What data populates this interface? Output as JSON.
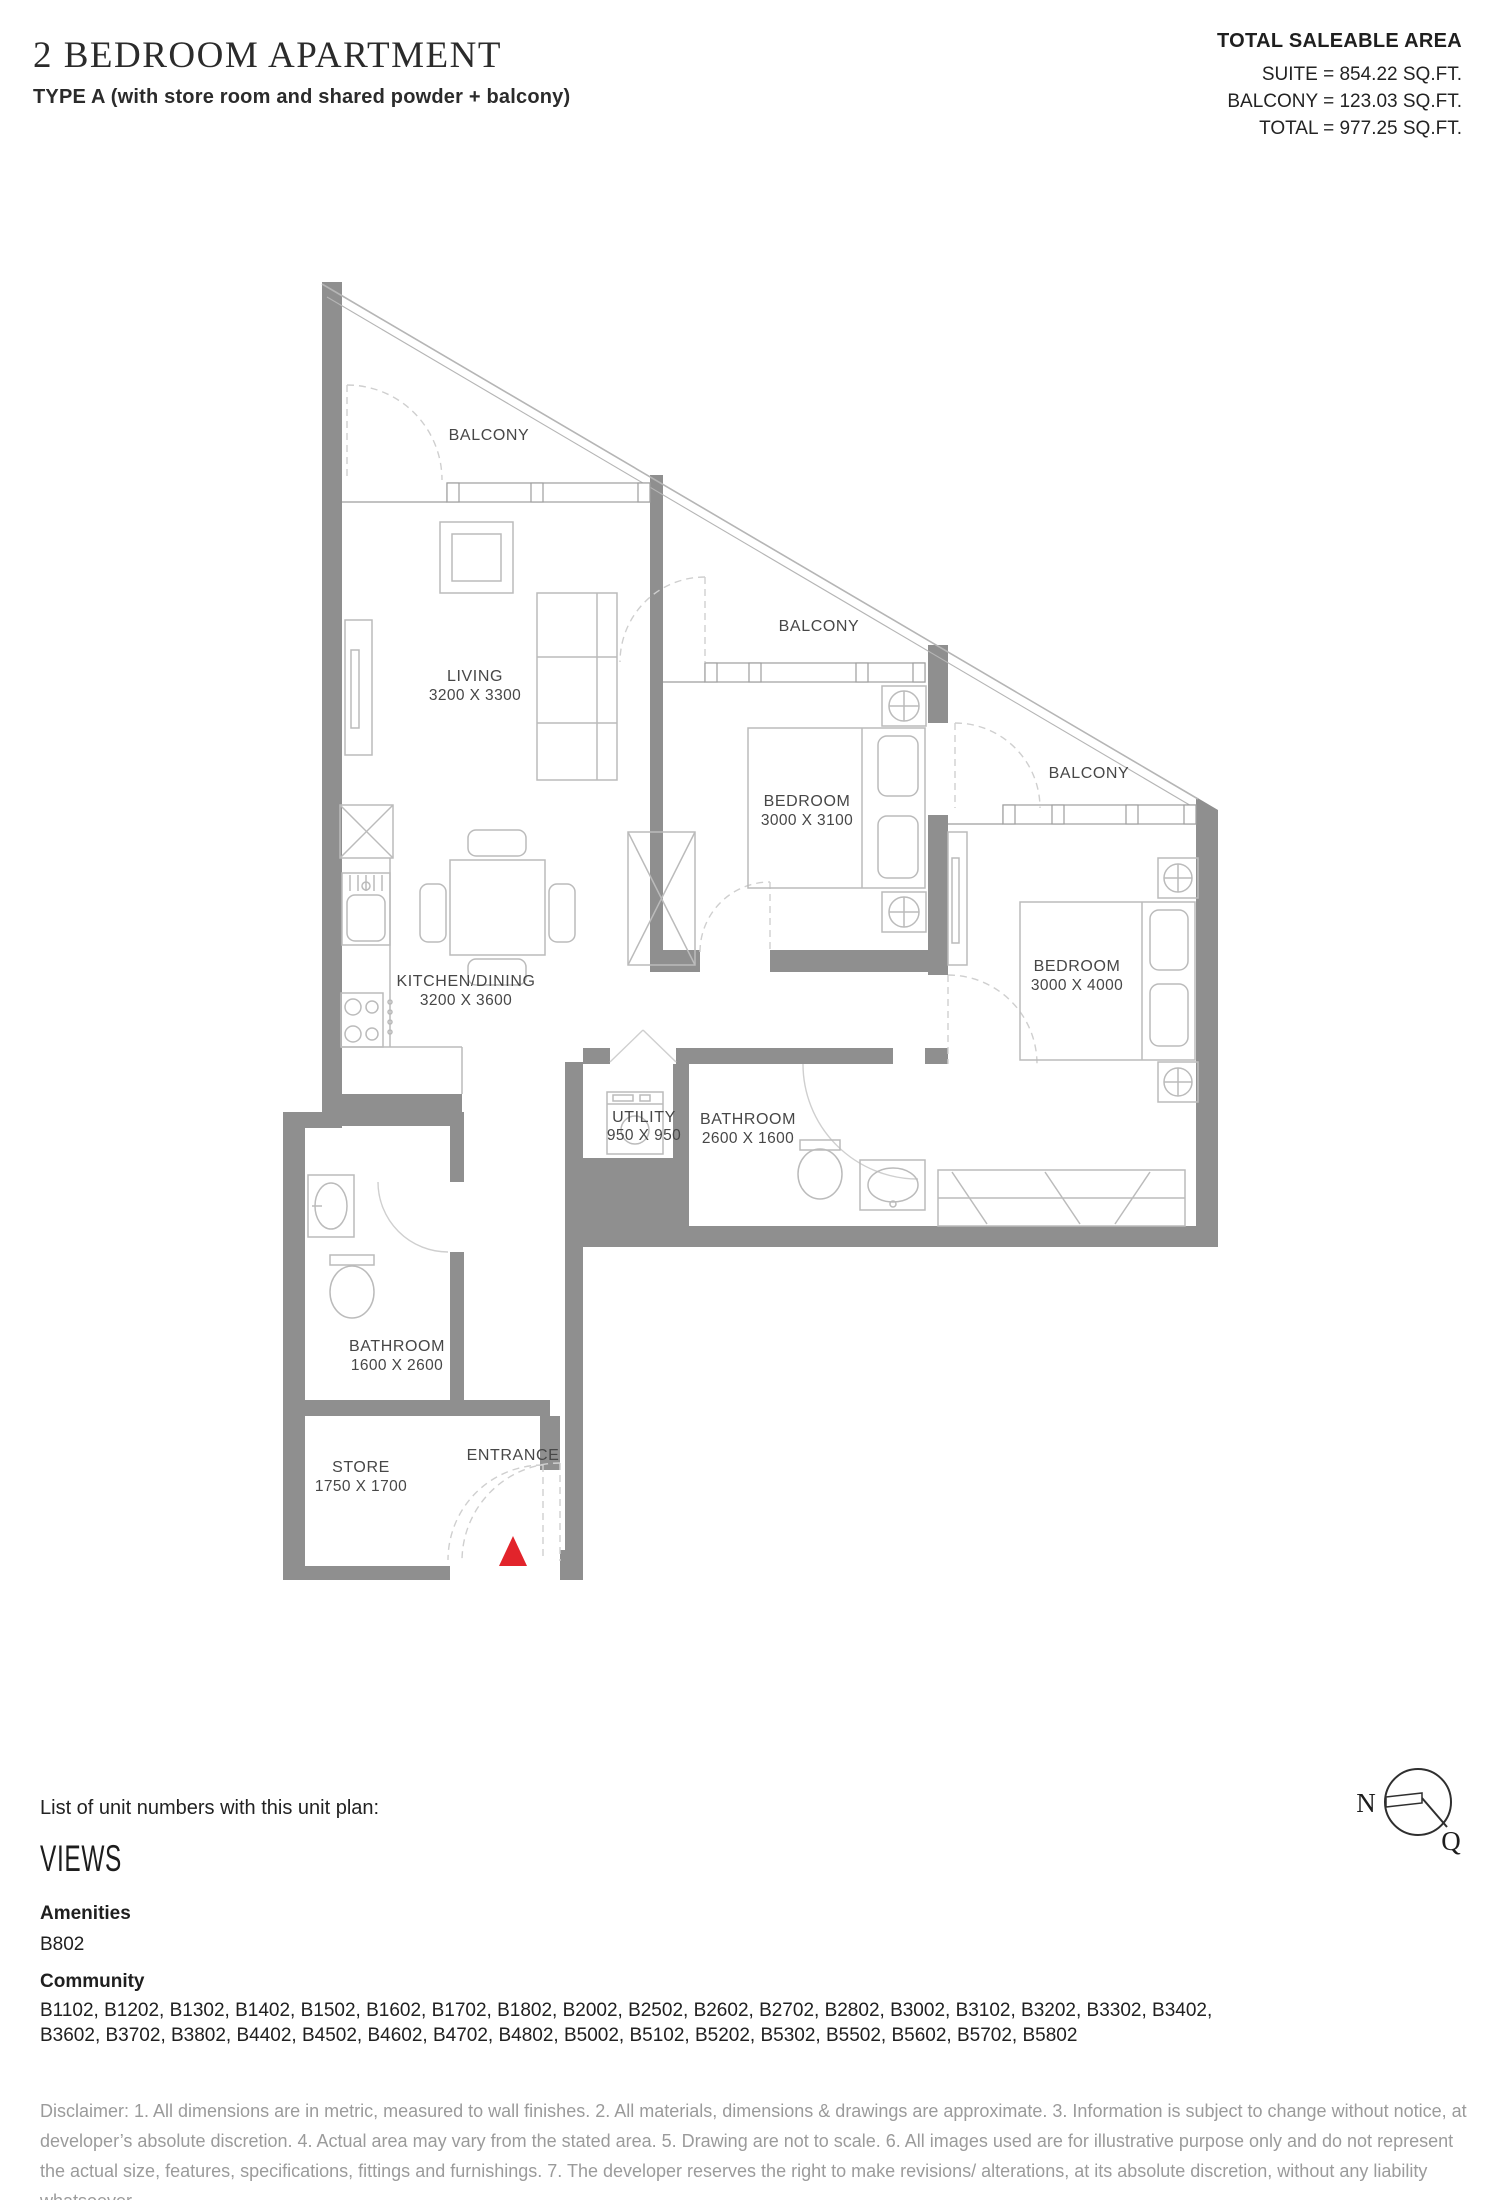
{
  "header": {
    "title": "2 BEDROOM APARTMENT",
    "subtitle": "TYPE A (with store room and shared powder + balcony)",
    "area_summary": {
      "heading": "TOTAL SALEABLE AREA",
      "suite": "SUITE = 854.22 SQ.FT.",
      "balcony": "BALCONY = 123.03 SQ.FT.",
      "total": "TOTAL = 977.25 SQ.FT."
    }
  },
  "floor_plan": {
    "rooms": [
      {
        "name": "LIVING",
        "dims": "3200 X 3300"
      },
      {
        "name": "BEDROOM",
        "dims": "3000 X 3100"
      },
      {
        "name": "BEDROOM",
        "dims": "3000 X 4000"
      },
      {
        "name": "KITCHEN/DINING",
        "dims": "3200 X 3600"
      },
      {
        "name": "UTILITY",
        "dims": "950 X 950"
      },
      {
        "name": "BATHROOM",
        "dims": "2600 X 1600"
      },
      {
        "name": "BATHROOM",
        "dims": "1600 X 2600"
      },
      {
        "name": "STORE",
        "dims": "1750 X 1700"
      }
    ],
    "balconies": [
      "BALCONY",
      "BALCONY",
      "BALCONY"
    ],
    "entrance_label": "ENTRANCE",
    "compass": {
      "north": "N",
      "qibla": "Q"
    },
    "colors": {
      "wall": "#8f8f8f",
      "entrance_marker": "#e2242b",
      "furniture_line": "#bbbbbb"
    }
  },
  "footer": {
    "list_title": "List of unit numbers with this unit plan:",
    "views_heading": "VIEWS",
    "amenities_label": "Amenities",
    "amenities_units": "B802",
    "community_label": "Community",
    "community_units_lines": [
      "B1102, B1202, B1302, B1402, B1502, B1602, B1702, B1802, B2002, B2502, B2602, B2702, B2802, B3002, B3102, B3202, B3302, B3402,",
      "B3602, B3702, B3802, B4402, B4502, B4602, B4702, B4802, B5002, B5102, B5202, B5302, B5502, B5602, B5702, B5802"
    ],
    "disclaimer": "Disclaimer: 1. All dimensions are in metric, measured to wall finishes. 2. All materials, dimensions & drawings are approximate. 3. Information is subject to change without notice, at developer’s absolute discretion. 4. Actual area may vary from the stated area. 5. Drawing are not to scale. 6. All images used are for illustrative purpose only and do not represent the actual size, features, specifications, fittings and furnishings. 7. The developer reserves the right to make revisions/ alterations, at its absolute discretion, without any liability whatsoever."
  }
}
